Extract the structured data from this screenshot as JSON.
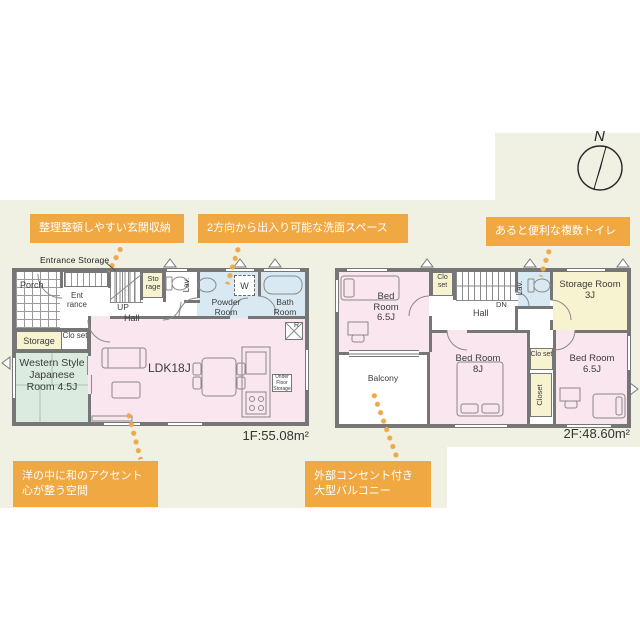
{
  "colors": {
    "accent_orange": "#f0a843",
    "cream_bg": "#f1f1e3",
    "room_pink": "#fae6ef",
    "room_blue": "#d9e9f3",
    "room_green": "#dcebdf",
    "room_yellow": "#f7f2cf",
    "wall_gray": "#767676"
  },
  "compass": {
    "label": "N"
  },
  "callouts": {
    "entrance_storage": "整理整頓しやすい玄関収納",
    "powder_room": "2方向から出入り可能な洗面スペース",
    "toilets": "あると便利な複数トイレ",
    "japanese_room_line1": "洋の中に和のアクセント",
    "japanese_room_line2": "心が整う空間",
    "balcony_line1": "外部コンセント付き",
    "balcony_line2": "大型バルコニー"
  },
  "floor1": {
    "area_label": "1F:55.08m²",
    "entrance_storage_note": "Entrance Storage",
    "rooms": {
      "porch": "Porch",
      "entrance": "Ent rance",
      "up": "UP",
      "hall": "Hall",
      "storage_top": "Sto rage",
      "lav": "Lav.",
      "powder_room": "Powder Room",
      "washer": "W",
      "bath_room": "Bath Room",
      "storage": "Storage",
      "closet": "Clo set",
      "japanese_room": "Western Style Japanese Room 4.5J",
      "ldk": "LDK18J",
      "under_floor_storage": "Under Floor Storage",
      "refrigerator": "R"
    }
  },
  "floor2": {
    "area_label": "2F:48.60m²",
    "rooms": {
      "bedroom_nw": "Bed Room 6.5J",
      "closet_top": "Clo set",
      "hall": "Hall",
      "down": "DN",
      "lav": "Lav.",
      "storage_room": "Storage Room 3J",
      "balcony": "Balcony",
      "bedroom_s": "Bed Room 8J",
      "closet_mid": "Clo set",
      "closet_vertical": "Closet",
      "bedroom_se": "Bed Room 6.5J"
    }
  }
}
